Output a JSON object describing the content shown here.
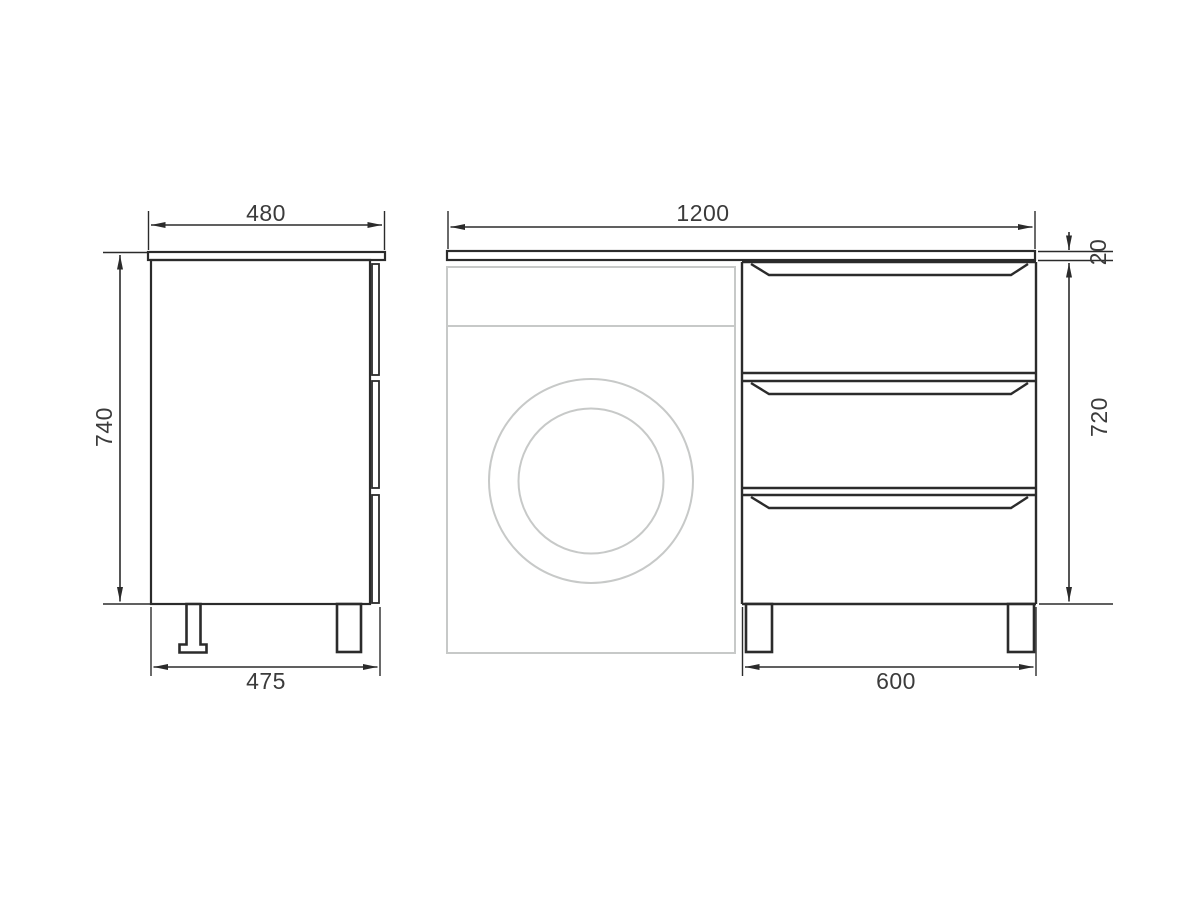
{
  "colors": {
    "background": "#ffffff",
    "line": "#2b2b2b",
    "machine_outline": "#c7c9c8",
    "text": "#3b3b3b"
  },
  "drawing": {
    "side_view": {
      "top_width_mm": "480",
      "height_mm": "740",
      "bottom_width_mm": "475"
    },
    "front_view": {
      "total_width_mm": "1200",
      "countertop_thickness_mm": "20",
      "cabinet_height_mm": "720",
      "drawer_unit_width_mm": "600"
    }
  }
}
